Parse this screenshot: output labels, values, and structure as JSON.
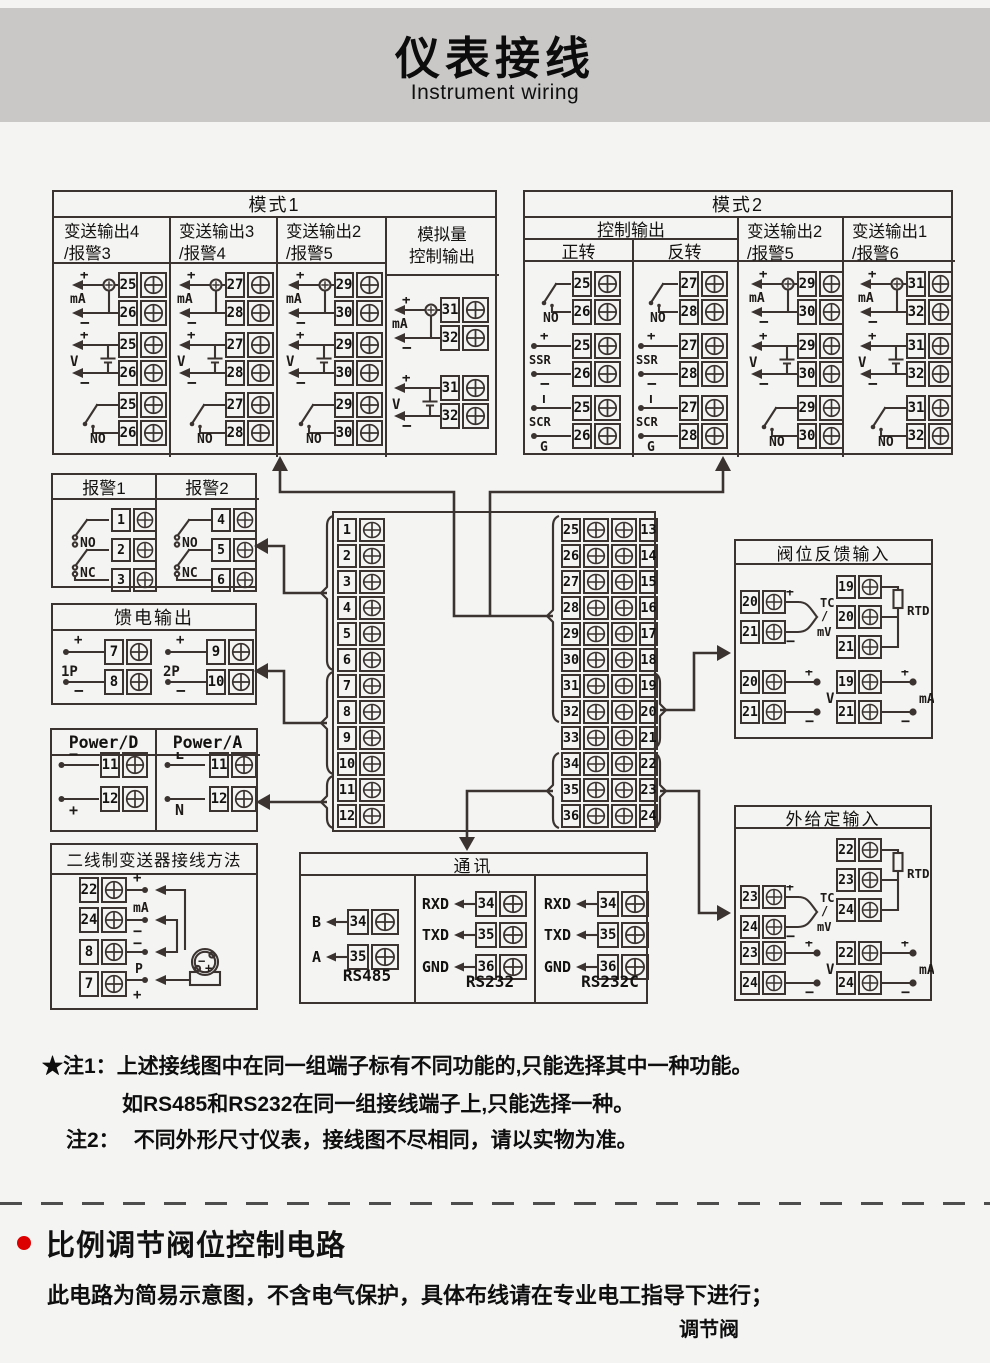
{
  "header": {
    "title": "仪表接线",
    "subtitle": "Instrument wiring"
  },
  "colors": {
    "line": "#3a3330",
    "accent_red": "#dd0000",
    "header_band": "#c9c8c7",
    "page_bg": "#f4f4f3"
  },
  "panels": {
    "mode1": {
      "title": "模式1",
      "cols": [
        {
          "h1": "变送输出4",
          "h2": "/报警3",
          "units": [
            {
              "k": "ma",
              "label": "mA",
              "plus": "+",
              "minus": "−",
              "t": [
                "25",
                "26"
              ]
            },
            {
              "k": "v",
              "label": "V",
              "plus": "+",
              "minus": "−",
              "t": [
                "25",
                "26"
              ]
            },
            {
              "k": "no",
              "label": "NO",
              "t": [
                "25",
                "26"
              ]
            }
          ]
        },
        {
          "h1": "变送输出3",
          "h2": "/报警4",
          "units": [
            {
              "k": "ma",
              "label": "mA",
              "plus": "+",
              "minus": "−",
              "t": [
                "27",
                "28"
              ]
            },
            {
              "k": "v",
              "label": "V",
              "plus": "+",
              "minus": "−",
              "t": [
                "27",
                "28"
              ]
            },
            {
              "k": "no",
              "label": "NO",
              "t": [
                "27",
                "28"
              ]
            }
          ]
        },
        {
          "h1": "变送输出2",
          "h2": "/报警5",
          "units": [
            {
              "k": "ma",
              "label": "mA",
              "plus": "+",
              "minus": "−",
              "t": [
                "29",
                "30"
              ]
            },
            {
              "k": "v",
              "label": "V",
              "plus": "+",
              "minus": "−",
              "t": [
                "29",
                "30"
              ]
            },
            {
              "k": "no",
              "label": "NO",
              "t": [
                "29",
                "30"
              ]
            }
          ]
        },
        {
          "h1": "模拟量",
          "h2": "控制输出",
          "units": [
            {
              "k": "ma",
              "label": "mA",
              "plus": "+",
              "minus": "−",
              "t": [
                "31",
                "32"
              ]
            },
            {
              "k": "v",
              "label": "V",
              "plus": "+",
              "minus": "−",
              "t": [
                "31",
                "32"
              ]
            }
          ]
        }
      ]
    },
    "mode2": {
      "title": "模式2",
      "group": "控制输出",
      "cols": [
        {
          "h1": "正转",
          "units": [
            {
              "k": "no",
              "label": "NO",
              "t": [
                "25",
                "26"
              ]
            },
            {
              "k": "ssr",
              "label": "SSR",
              "plus": "+",
              "minus": "−",
              "t": [
                "25",
                "26"
              ]
            },
            {
              "k": "scr",
              "label": "SCR",
              "plus": "T",
              "minus": "G",
              "t": [
                "25",
                "26"
              ]
            }
          ]
        },
        {
          "h1": "反转",
          "units": [
            {
              "k": "no",
              "label": "NO",
              "t": [
                "27",
                "28"
              ]
            },
            {
              "k": "ssr",
              "label": "SSR",
              "plus": "+",
              "minus": "−",
              "t": [
                "27",
                "28"
              ]
            },
            {
              "k": "scr",
              "label": "SCR",
              "plus": "T",
              "minus": "G",
              "t": [
                "27",
                "28"
              ]
            }
          ]
        },
        {
          "h1": "变送输出2",
          "h2": "/报警5",
          "units": [
            {
              "k": "ma",
              "label": "mA",
              "plus": "+",
              "minus": "−",
              "t": [
                "29",
                "30"
              ]
            },
            {
              "k": "v",
              "label": "V",
              "plus": "+",
              "minus": "−",
              "t": [
                "29",
                "30"
              ]
            },
            {
              "k": "no",
              "label": "NO",
              "t": [
                "29",
                "30"
              ]
            }
          ]
        },
        {
          "h1": "变送输出1",
          "h2": "/报警6",
          "units": [
            {
              "k": "ma",
              "label": "mA",
              "plus": "+",
              "minus": "−",
              "t": [
                "31",
                "32"
              ]
            },
            {
              "k": "v",
              "label": "V",
              "plus": "+",
              "minus": "−",
              "t": [
                "31",
                "32"
              ]
            },
            {
              "k": "no",
              "label": "NO",
              "t": [
                "31",
                "32"
              ]
            }
          ]
        }
      ]
    },
    "alarm": {
      "cols": [
        {
          "h": "报警1",
          "no": "NO",
          "nc": "NC",
          "t": [
            "1",
            "2",
            "3"
          ]
        },
        {
          "h": "报警2",
          "no": "NO",
          "nc": "NC",
          "t": [
            "4",
            "5",
            "6"
          ]
        }
      ]
    },
    "feed": {
      "title": "馈电输出",
      "units": [
        {
          "label": "1P",
          "plus": "+",
          "minus": "−",
          "t": [
            "7",
            "8"
          ]
        },
        {
          "label": "2P",
          "plus": "+",
          "minus": "−",
          "t": [
            "9",
            "10"
          ]
        }
      ]
    },
    "power": {
      "cols": [
        {
          "h": "Power/D",
          "rows": [
            {
              "m": "−",
              "t": "11"
            },
            {
              "m": "+",
              "t": "12"
            }
          ]
        },
        {
          "h": "Power/A",
          "rows": [
            {
              "m": "L",
              "t": "11"
            },
            {
              "m": "N",
              "t": "12"
            }
          ]
        }
      ]
    },
    "twowire": {
      "title": "二线制变送器接线方法",
      "t": [
        "22",
        "24",
        "8",
        "7"
      ],
      "marks": {
        "m1": "+",
        "m2": "mA",
        "m3": "−",
        "m4": "−",
        "m5": "P",
        "m6": "+",
        "tminus": "−",
        "tplus": "+"
      }
    },
    "center": {
      "left": [
        "1",
        "2",
        "3",
        "4",
        "5",
        "6",
        "7",
        "8",
        "9",
        "10",
        "11",
        "12"
      ],
      "mid": [
        "25",
        "26",
        "27",
        "28",
        "29",
        "30",
        "31",
        "32",
        "33",
        "34",
        "35",
        "36"
      ],
      "right": [
        "13",
        "14",
        "15",
        "16",
        "17",
        "18",
        "19",
        "20",
        "21",
        "22",
        "23",
        "24"
      ]
    },
    "valve": {
      "title": "阀位反馈输入",
      "tc": {
        "plus": "+",
        "minus": "−",
        "l1": "TC",
        "l2": "/",
        "l3": "mV",
        "t": [
          "20",
          "21"
        ]
      },
      "rtd": {
        "label": "RTD",
        "t": [
          "19",
          "20",
          "21"
        ]
      },
      "v": {
        "label": "V",
        "plus": "+",
        "minus": "−",
        "t": [
          "20",
          "21"
        ]
      },
      "ma": {
        "label": "mA",
        "plus": "+",
        "minus": "−",
        "t": [
          "19",
          "21"
        ]
      }
    },
    "ext": {
      "title": "外给定输入",
      "tc": {
        "plus": "+",
        "minus": "−",
        "l1": "TC",
        "l2": "/",
        "l3": "mV",
        "t": [
          "23",
          "24"
        ]
      },
      "rtd": {
        "label": "RTD",
        "t": [
          "22",
          "23",
          "24"
        ]
      },
      "v": {
        "label": "V",
        "plus": "+",
        "minus": "−",
        "t": [
          "23",
          "24"
        ]
      },
      "ma": {
        "label": "mA",
        "plus": "+",
        "minus": "−",
        "t": [
          "22",
          "24"
        ]
      }
    },
    "comm": {
      "title": "通讯",
      "groups": [
        {
          "caption": "RS485",
          "pins": [
            {
              "name": "B",
              "t": "34"
            },
            {
              "name": "A",
              "t": "35"
            }
          ]
        },
        {
          "caption": "RS232",
          "pins": [
            {
              "name": "RXD",
              "t": "34"
            },
            {
              "name": "TXD",
              "t": "35"
            },
            {
              "name": "GND",
              "t": "36"
            }
          ]
        },
        {
          "caption": "RS232C",
          "pins": [
            {
              "name": "RXD",
              "t": "34"
            },
            {
              "name": "TXD",
              "t": "35"
            },
            {
              "name": "GND",
              "t": "36"
            }
          ]
        }
      ]
    }
  },
  "notes": {
    "n1_label": "★注1：",
    "n1_line1": "上述接线图中在同一组端子标有不同功能的,只能选择其中一种功能。",
    "n1_line2": "如RS485和RS232在同一组接线端子上,只能选择一种。",
    "n2_label": "注2：",
    "n2_text": "不同外形尺寸仪表，接线图不尽相同，请以实物为准。"
  },
  "section": {
    "title": "比例调节阀位控制电路",
    "body": "此电路为简易示意图，不含电气保护，具体布线请在专业电工指导下进行；",
    "caption": "调节阀"
  }
}
